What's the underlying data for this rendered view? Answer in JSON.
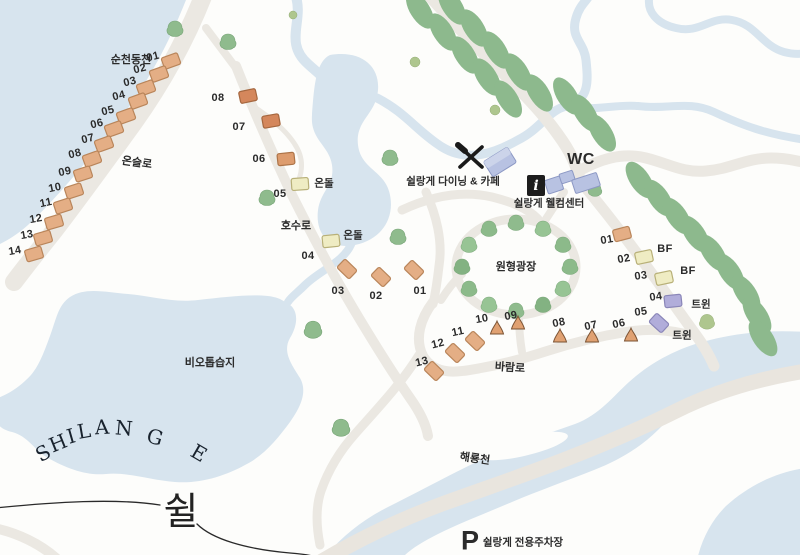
{
  "brand": {
    "letters": [
      "S",
      "H",
      "I",
      "L",
      "A",
      "N",
      "G",
      "E"
    ],
    "hangul": "쉴"
  },
  "waters": {
    "top_river": "순천동천",
    "wetland": "비오톱습지",
    "bottom_river": "해룡천"
  },
  "roads": {
    "onseul": "온슬로",
    "hosu": "호수로",
    "baram": "바람로"
  },
  "facilities": {
    "dining": "쉴랑게 다이닝 & 카페",
    "welcome": "쉴랑게 웰컴센터",
    "wc": "WC",
    "info_symbol": "i",
    "plaza": "원형광장",
    "parking_symbol": "P",
    "parking": "쉴랑게 전용주차장"
  },
  "unit_types": {
    "ondol": "온돌",
    "bf": "BF",
    "twin": "트윈"
  },
  "sites": {
    "left": [
      "01",
      "02",
      "03",
      "04",
      "05",
      "06",
      "07",
      "08",
      "09",
      "10",
      "11",
      "12",
      "13",
      "14"
    ],
    "middle": [
      "01",
      "02",
      "03",
      "04",
      "05",
      "06",
      "07",
      "08"
    ],
    "bottom": [
      "06",
      "07",
      "08",
      "09",
      "10",
      "11",
      "12",
      "13"
    ],
    "right": [
      "01",
      "02",
      "03",
      "04",
      "05"
    ]
  },
  "colors": {
    "water": "#d7e4ee",
    "road": "#ebe8e2",
    "tree_green": "#8fbb8d",
    "cabin_tan": "#e4ae85",
    "cabin_dark": "#d4875c",
    "cabin_ondol": "#efecc3",
    "cabin_twin": "#b1adda",
    "building_blue": "#b8c2e2"
  }
}
